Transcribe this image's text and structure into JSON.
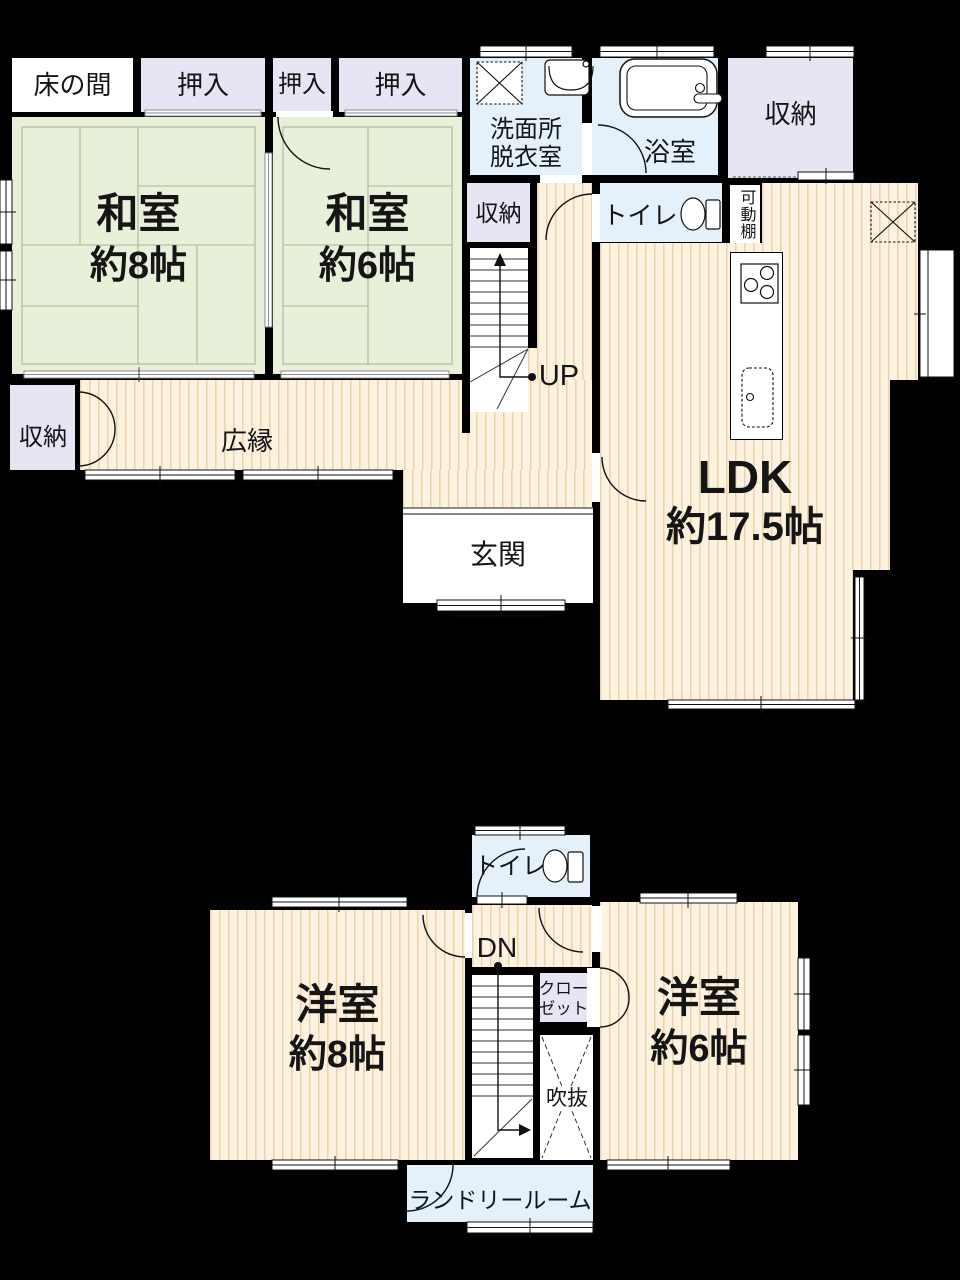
{
  "plan_title": "floor-plan",
  "colors": {
    "background": "#000000",
    "tatami_room": "#e9f0da",
    "closet": "#e7e4f4",
    "wet_room": "#e4f1fa",
    "wood_floor_base": "#fcf2df",
    "wood_floor_stripe": "#eed3a8",
    "white_room": "#ffffff",
    "line": "#151515"
  },
  "floor1": {
    "tokonoma": "床の間",
    "oshiire1": "押入",
    "oshiire2": "押入",
    "oshiire3": "押入",
    "washitsu8": {
      "name": "和室",
      "size": "約8帖"
    },
    "washitsu6": {
      "name": "和室",
      "size": "約6帖"
    },
    "senmenjo": {
      "line1": "洗面所",
      "line2": "脱衣室"
    },
    "bathroom": "浴室",
    "storage_top": "収納",
    "storage_hall": "収納",
    "toilet": "トイレ",
    "kadodana": "可動棚",
    "stairs_up": "UP",
    "hiroen": "広縁",
    "storage_left": "収納",
    "genkan": "玄関",
    "ldk": {
      "name": "LDK",
      "size": "約17.5帖"
    }
  },
  "floor2": {
    "toilet": "トイレ",
    "stairs_down": "DN",
    "closet": {
      "line1": "クロー",
      "line2": "ゼット"
    },
    "fukinuke": "吹抜",
    "yoshitsu8": {
      "name": "洋室",
      "size": "約8帖"
    },
    "yoshitsu6": {
      "name": "洋室",
      "size": "約6帖"
    },
    "laundry": "ランドリールーム"
  },
  "icons": {
    "washing_machine": "washing-machine-icon",
    "washbasin": "washbasin-icon",
    "bathtub": "bathtub-icon",
    "toilet_1f": "toilet-icon",
    "toilet_2f": "toilet-icon",
    "stove": "stove-icon",
    "kitchen_sink": "kitchen-sink-icon",
    "refrigerator_space": "refrigerator-x-icon",
    "void_cross": "void-x-icon",
    "up_arrow": "stairs-up-arrow-icon",
    "down_arrow": "stairs-down-arrow-icon"
  }
}
